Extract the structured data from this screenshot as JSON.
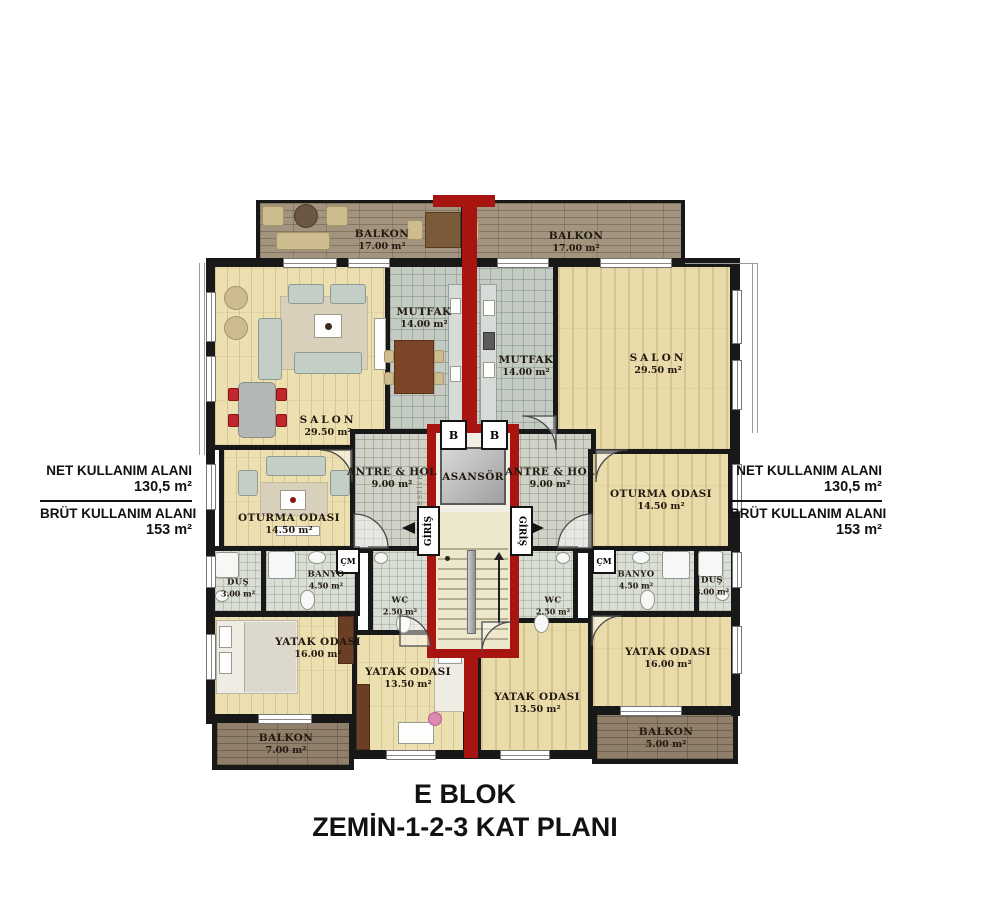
{
  "title": {
    "line1": "E BLOK",
    "line2": "ZEMİN-1-2-3 KAT PLANI"
  },
  "info": {
    "net_label": "NET KULLANIM ALANI",
    "net_value": "130,5 m²",
    "brut_label": "BRÜT KULLANIM ALANI",
    "brut_value": "153 m²"
  },
  "rooms": {
    "balkon_tl": {
      "name": "BALKON",
      "area": "17.00 m²"
    },
    "balkon_tr": {
      "name": "BALKON",
      "area": "17.00 m²"
    },
    "mutfak_l": {
      "name": "MUTFAK",
      "area": "14.00 m²"
    },
    "mutfak_r": {
      "name": "MUTFAK",
      "area": "14.00 m²"
    },
    "salon_l": {
      "name": "SALON",
      "area": "29.50 m²"
    },
    "salon_r": {
      "name": "SALON",
      "area": "29.50 m²"
    },
    "antre_l": {
      "name": "ANTRE & HOL",
      "area": "9.00 m²"
    },
    "antre_r": {
      "name": "ANTRE & HOL",
      "area": "9.00 m²"
    },
    "oturma_l": {
      "name": "OTURMA ODASI",
      "area": "14.50 m²"
    },
    "oturma_r": {
      "name": "OTURMA ODASI",
      "area": "14.50 m²"
    },
    "dus_l": {
      "name": "DUŞ",
      "area": "3.00 m²"
    },
    "dus_r": {
      "name": "DUŞ",
      "area": "3.00 m²"
    },
    "banyo_l": {
      "name": "BANYO",
      "area": "4.50 m²"
    },
    "banyo_r": {
      "name": "BANYO",
      "area": "4.50 m²"
    },
    "wc_l": {
      "name": "WC",
      "area": "2.50 m²"
    },
    "wc_r": {
      "name": "WC",
      "area": "2.50 m²"
    },
    "yatak_l1": {
      "name": "YATAK ODASI",
      "area": "16.00 m²"
    },
    "yatak_l2": {
      "name": "YATAK ODASI",
      "area": "13.50 m²"
    },
    "yatak_r2": {
      "name": "YATAK ODASI",
      "area": "13.50 m²"
    },
    "yatak_r1": {
      "name": "YATAK ODASI",
      "area": "16.00 m²"
    },
    "balkon_bl": {
      "name": "BALKON",
      "area": "7.00 m²"
    },
    "balkon_br": {
      "name": "BALKON",
      "area": "5.00 m²"
    }
  },
  "core": {
    "asansor": "ASANSÖR",
    "giris": "GİRİŞ",
    "vestiyer": "VESTİYER",
    "shaft_b": "B",
    "cm": "ÇM"
  },
  "colors": {
    "accent_red": "#a81410",
    "wall_black": "#181818",
    "wood_floor": "#ecdfb0",
    "kitchen_tile": "#c3cbc2",
    "hall_tile": "#cfd3c7",
    "bath_tile": "#dadfd5",
    "balcony_deck_top": "#a39480",
    "balcony_deck_bottom": "#8f7f6b"
  }
}
